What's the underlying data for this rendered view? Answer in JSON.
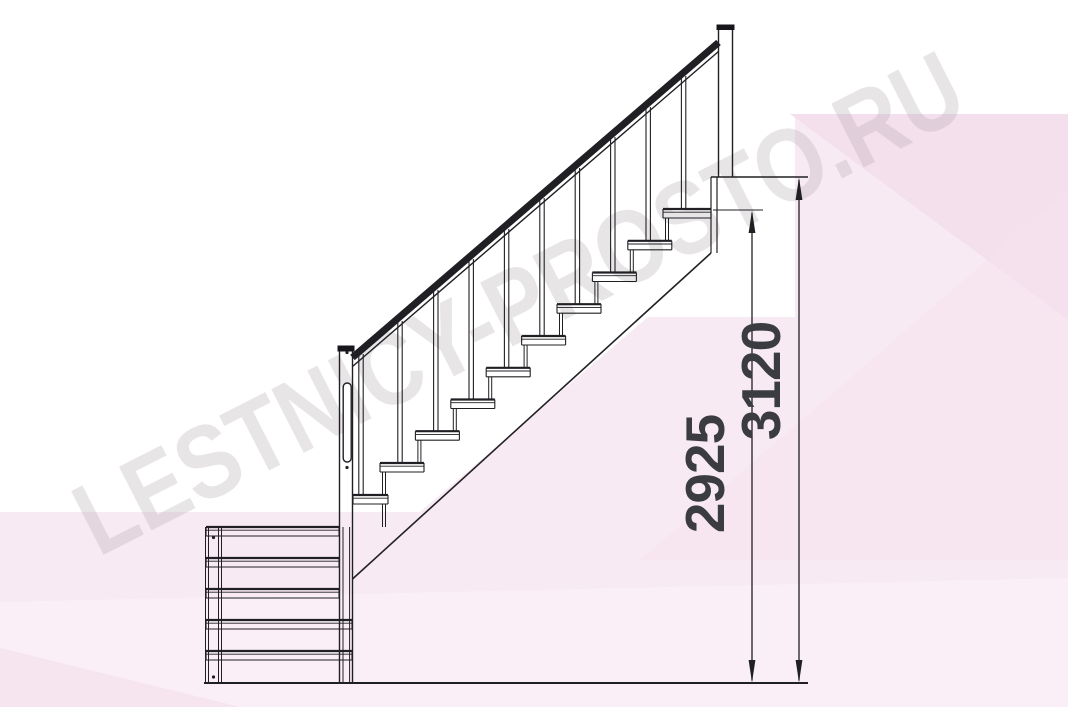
{
  "drawing_title": "quarter-turn staircase side elevation",
  "watermark": {
    "text": "LESTNICY-PROSTO.RU"
  },
  "dimensions": {
    "floor_to_top_tread": {
      "value": "2925",
      "orientation": "vertical",
      "line_x": 752
    },
    "floor_to_landing": {
      "value": "3120",
      "orientation": "vertical",
      "line_x": 799
    }
  },
  "structure": {
    "main_flight_tread_count": 10,
    "lower_flight_tread_count": 5,
    "baluster_count": 10,
    "has_handrail": true,
    "has_stringer": true,
    "has_top_post": true,
    "has_newel_post": true
  },
  "colors": {
    "line": "#202024",
    "dim_text": "#3b3b42",
    "watermark": "#b5abb3",
    "pink_main": "#f8eaf2",
    "pink_wedge": "#f4dfec",
    "background": "#ffffff"
  },
  "geom": {
    "line_color": "#202024",
    "background": [
      {
        "name": "pink-backdrop-main",
        "points": "0,512 420,512 648,317 795,317 795,114 1068,114 1068,707 0,707",
        "fill": "#f8eaf2"
      },
      {
        "name": "pink-wedge-top-right",
        "points": "790,114 1068,114 1068,320",
        "fill": "#f4dfec"
      },
      {
        "name": "pink-wedge-right",
        "points": "640,560 1068,190 1068,560",
        "fill": "#f5e2ee",
        "opacity": 0.55
      },
      {
        "name": "pink-band-bottom",
        "points": "0,602 1068,578 1068,707 0,707",
        "fill": "#faeff6"
      },
      {
        "name": "pink-wedge-bottom-left",
        "points": "0,648 240,707 0,707",
        "fill": "#f1d9e8",
        "opacity": 0.5
      }
    ],
    "treads": [
      {
        "n": "tread-main-0",
        "x": 353,
        "y": 495,
        "w": 35
      },
      {
        "n": "tread-main-1",
        "x": 380,
        "y": 463,
        "w": 44
      },
      {
        "n": "tread-main-2",
        "x": 415.4,
        "y": 431.2,
        "w": 44
      },
      {
        "n": "tread-main-3",
        "x": 450.8,
        "y": 399.5,
        "w": 44
      },
      {
        "n": "tread-main-4",
        "x": 486.2,
        "y": 367.8,
        "w": 44
      },
      {
        "n": "tread-main-5",
        "x": 521.6,
        "y": 336,
        "w": 44
      },
      {
        "n": "tread-main-6",
        "x": 557,
        "y": 304.2,
        "w": 44
      },
      {
        "n": "tread-main-7",
        "x": 592.4,
        "y": 272.5,
        "w": 44
      },
      {
        "n": "tread-main-8",
        "x": 627.8,
        "y": 240.8,
        "w": 44
      },
      {
        "n": "tread-main-9",
        "x": 663,
        "y": 209,
        "w": 48
      },
      {
        "n": "tread-lower-1",
        "x": 206,
        "y": 527,
        "w": 133
      },
      {
        "n": "tread-lower-2",
        "x": 206,
        "y": 558,
        "w": 133
      },
      {
        "n": "tread-lower-3",
        "x": 206,
        "y": 589,
        "w": 133
      },
      {
        "n": "tread-lower-4",
        "x": 206,
        "y": 620,
        "w": 146
      },
      {
        "n": "tread-lower-5",
        "x": 206,
        "y": 651,
        "w": 146
      }
    ],
    "pairs": [
      {
        "n": "baluster",
        "x": 361,
        "y1": 354,
        "y2": 495
      },
      {
        "n": "baluster",
        "x": 400,
        "y1": 321,
        "y2": 463
      },
      {
        "n": "baluster",
        "x": 435.8,
        "y1": 290,
        "y2": 431.2
      },
      {
        "n": "baluster",
        "x": 471.2,
        "y1": 259,
        "y2": 399.5
      },
      {
        "n": "baluster",
        "x": 506.6,
        "y1": 229,
        "y2": 367.8
      },
      {
        "n": "baluster",
        "x": 542,
        "y1": 198,
        "y2": 336
      },
      {
        "n": "baluster",
        "x": 577.4,
        "y1": 168,
        "y2": 304.2
      },
      {
        "n": "baluster",
        "x": 612.8,
        "y1": 137,
        "y2": 272.5
      },
      {
        "n": "baluster",
        "x": 648.2,
        "y1": 107,
        "y2": 240.8
      },
      {
        "n": "baluster",
        "x": 683.6,
        "y1": 76,
        "y2": 209
      },
      {
        "n": "support-rod",
        "x": 384,
        "y1": 472,
        "y2": 495,
        "gap": 3,
        "w": 1
      },
      {
        "n": "support-rod",
        "x": 419.4,
        "y1": 440,
        "y2": 463,
        "gap": 3,
        "w": 1
      },
      {
        "n": "support-rod",
        "x": 454.8,
        "y1": 408.5,
        "y2": 431.2,
        "gap": 3,
        "w": 1
      },
      {
        "n": "support-rod",
        "x": 490.2,
        "y1": 377,
        "y2": 399.5,
        "gap": 3,
        "w": 1
      },
      {
        "n": "support-rod",
        "x": 525.6,
        "y1": 345,
        "y2": 367.8,
        "gap": 3,
        "w": 1
      },
      {
        "n": "support-rod",
        "x": 561,
        "y1": 313.2,
        "y2": 336,
        "gap": 3,
        "w": 1
      },
      {
        "n": "support-rod",
        "x": 596.4,
        "y1": 281.5,
        "y2": 304.2,
        "gap": 3,
        "w": 1
      },
      {
        "n": "support-rod",
        "x": 631.8,
        "y1": 250,
        "y2": 272.5,
        "gap": 3,
        "w": 1
      },
      {
        "n": "support-rod",
        "x": 667,
        "y1": 218,
        "y2": 240.8,
        "gap": 3,
        "w": 1
      },
      {
        "n": "support-rod",
        "x": 384,
        "y1": 504,
        "y2": 527,
        "gap": 3,
        "w": 1
      },
      {
        "n": "top-post",
        "x": 725.5,
        "y1": 29,
        "y2": 177,
        "gap": 14,
        "w": 1.4
      },
      {
        "n": "newel-post",
        "x": 346,
        "y1": 351,
        "y2": 683,
        "gap": 13,
        "w": 1.4
      },
      {
        "n": "landing-trimmer",
        "x": 714,
        "y1": 177,
        "y2": 253,
        "gap": 6,
        "w": 1.2
      },
      {
        "n": "lower-stile-left-outer",
        "x": 207,
        "y1": 527,
        "y2": 683,
        "gap": 3,
        "w": 1
      },
      {
        "n": "lower-stile-left-inner",
        "x": 220,
        "y1": 527,
        "y2": 683,
        "gap": 3,
        "w": 1
      },
      {
        "n": "lower-stile-right-inner",
        "x": 346.3,
        "y1": 527,
        "y2": 683,
        "gap": 6.6,
        "w": 1
      },
      {
        "n": "newel-handle-inner",
        "x": 347,
        "y1": 388,
        "y2": 457,
        "gap": 2.6,
        "w": 0.9
      }
    ],
    "lines": [
      {
        "n": "handrail",
        "x1": 352.5,
        "y1": 357.5,
        "x2": 718.5,
        "y2": 42.5,
        "w": 7
      },
      {
        "n": "handrail-lower-edge",
        "x1": 352.5,
        "y1": 366.5,
        "x2": 718.5,
        "y2": 51.5,
        "w": 1.4
      },
      {
        "n": "stringer",
        "x1": 352.5,
        "y1": 579,
        "x2": 711,
        "y2": 253,
        "w": 1.6
      },
      {
        "n": "landing-floor-line",
        "x1": 711,
        "y1": 177,
        "x2": 808,
        "y2": 177,
        "w": 1.6
      },
      {
        "n": "ground-line",
        "x1": 204,
        "y1": 683,
        "x2": 808,
        "y2": 683,
        "w": 2
      },
      {
        "n": "dim-extension-2925",
        "x1": 713,
        "y1": 210,
        "x2": 763,
        "y2": 210,
        "w": 1.1
      },
      {
        "n": "dim-line-2925",
        "x1": 752,
        "y1": 213,
        "x2": 752,
        "y2": 680.5,
        "w": 1.3
      },
      {
        "n": "dim-line-3120",
        "x1": 799,
        "y1": 180,
        "x2": 799,
        "y2": 680.5,
        "w": 1.3
      }
    ],
    "rects": [
      {
        "n": "top-post-cap",
        "x": 716.5,
        "y": 24.5,
        "w": 18,
        "h": 5.5,
        "fill": "#17171b"
      },
      {
        "n": "newel-post-cap",
        "x": 337.5,
        "y": 345.5,
        "w": 17,
        "h": 6,
        "fill": "#17171b"
      },
      {
        "n": "newel-handle",
        "x": 343.2,
        "y": 383,
        "w": 8,
        "h": 79,
        "rx": 4,
        "fill": "#ffffff",
        "stroke": "#202024",
        "sw": 1.4
      }
    ],
    "solids": [
      {
        "n": "arrowhead-up-2925",
        "points": "752,210.5 748.6,233 755.4,233"
      },
      {
        "n": "arrowhead-down-2925",
        "points": "752,682.5 748.6,660 755.4,660"
      },
      {
        "n": "arrowhead-up-3120",
        "points": "799,177.5 795.6,200 802.4,200"
      },
      {
        "n": "arrowhead-down-3120",
        "points": "799,682.5 795.6,660 802.4,660"
      }
    ],
    "dots": [
      {
        "n": "screw-dot",
        "x": 213.5,
        "y": 537.5
      },
      {
        "n": "screw-dot",
        "x": 213.5,
        "y": 677
      },
      {
        "n": "screw-dot",
        "x": 347,
        "y": 467.5
      },
      {
        "n": "screw-dot",
        "x": 347,
        "y": 352.5
      }
    ]
  }
}
